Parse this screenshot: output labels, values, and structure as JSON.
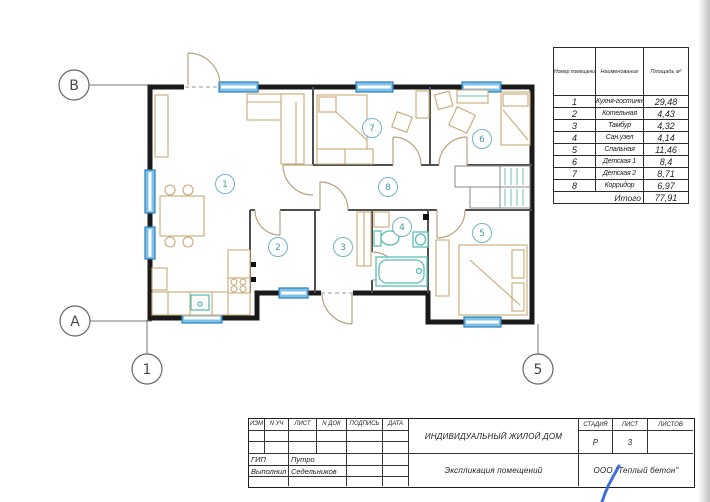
{
  "plan": {
    "axes": {
      "row_top": "В",
      "row_bottom": "А",
      "col_left": "1",
      "col_right": "5"
    }
  },
  "explication": {
    "headers": [
      "Номер помещения",
      "Наименование",
      "Площадь м²"
    ],
    "rows": [
      {
        "num": "1",
        "name": "Кухня-гостинная",
        "area": "29,48"
      },
      {
        "num": "2",
        "name": "Котельная",
        "area": "4,43"
      },
      {
        "num": "3",
        "name": "Тамбур",
        "area": "4,32"
      },
      {
        "num": "4",
        "name": "Сан.узел",
        "area": "4,14"
      },
      {
        "num": "5",
        "name": "Спальная",
        "area": "11,46"
      },
      {
        "num": "6",
        "name": "Детская 1",
        "area": "8,4"
      },
      {
        "num": "7",
        "name": "Детская 2",
        "area": "8,71"
      },
      {
        "num": "8",
        "name": "Корридор",
        "area": "6,97"
      }
    ],
    "total_label": "Итого",
    "total_area": "77,91"
  },
  "title_block": {
    "headers": [
      "ИЗМ",
      "N УЧ",
      "ЛИСТ",
      "N ДОК",
      "ПОДПИСЬ",
      "ДАТА"
    ],
    "signature_rows": [
      {
        "role": "ГИП",
        "name": "Путро"
      },
      {
        "role": "Выполнил",
        "name": "Седельников"
      }
    ],
    "project_title": "ИНДИВИДУАЛЬНЫЙ ЖИЛОЙ ДОМ",
    "document_title": "Экспликация помещений",
    "company": "ООО \"Теплый бетон\"",
    "stage": {
      "label": "СТАДИЯ",
      "value": "Р"
    },
    "sheet": {
      "label": "ЛИСТ",
      "value": "3"
    },
    "sheets": {
      "label": "ЛИСТОВ",
      "value": ""
    }
  },
  "colors": {
    "wall": "#1a1a1a",
    "window": "#7fc2e8",
    "window_border": "#2a7fb8",
    "furniture": "#c9a878",
    "fixture": "#5bbfb5",
    "room_badge": "#5fa8bb",
    "pen_mark": "#2e5fd6"
  }
}
